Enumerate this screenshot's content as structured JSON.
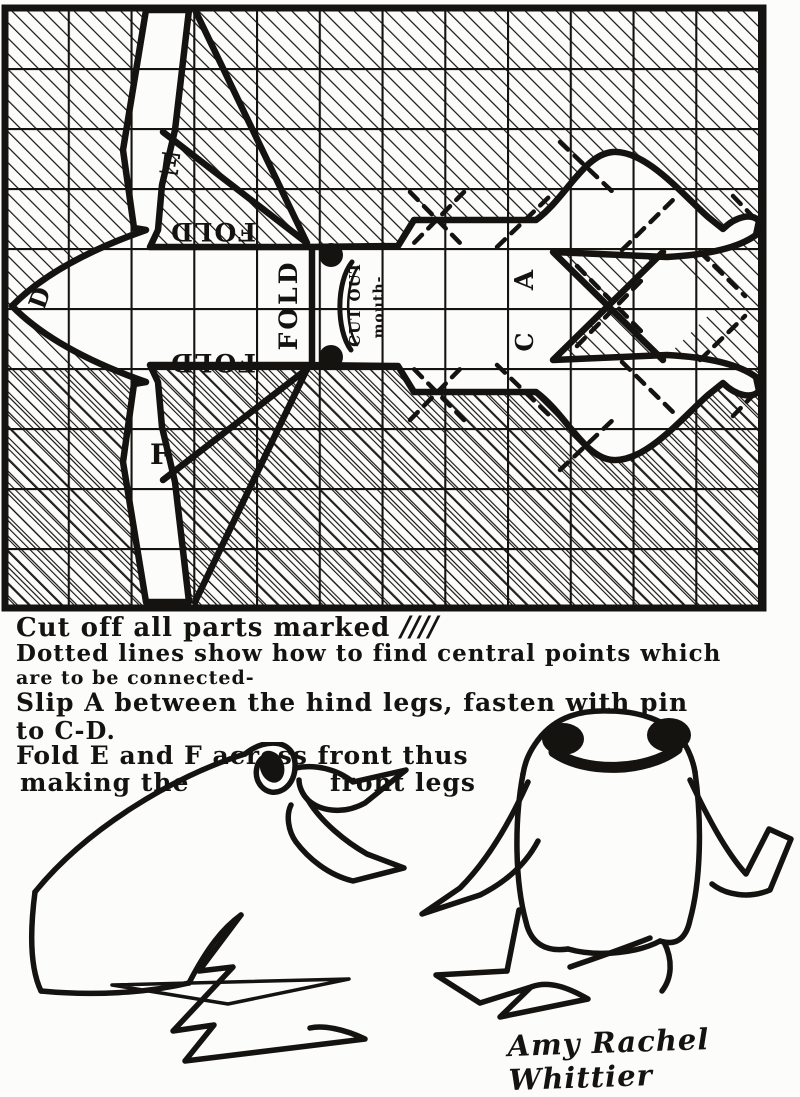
{
  "colors": {
    "ink": "#151310",
    "paper": "#fcfcfa"
  },
  "pattern": {
    "labels": {
      "flap_top": "E",
      "flap_bottom": "F",
      "fold_top": "FOLD",
      "fold_bottom": "FOLD",
      "fold_head": "FOLD",
      "cut_out": "CUT OUT",
      "mouth": "mouth-",
      "point_a": "A",
      "point_c": "C",
      "point_d": "D"
    }
  },
  "instructions": {
    "line1": "Cut off all parts marked",
    "line1_marks": "////",
    "line2": "Dotted lines show how to find central points which",
    "line3": "are to be connected-",
    "line4": "Slip A between the hind legs, fasten with pin",
    "line5": "to C-D.",
    "line6": "Fold E and F across front thus",
    "line7a": "making the",
    "line7b": "front legs"
  },
  "signature": "Amy Rachel Whittier"
}
